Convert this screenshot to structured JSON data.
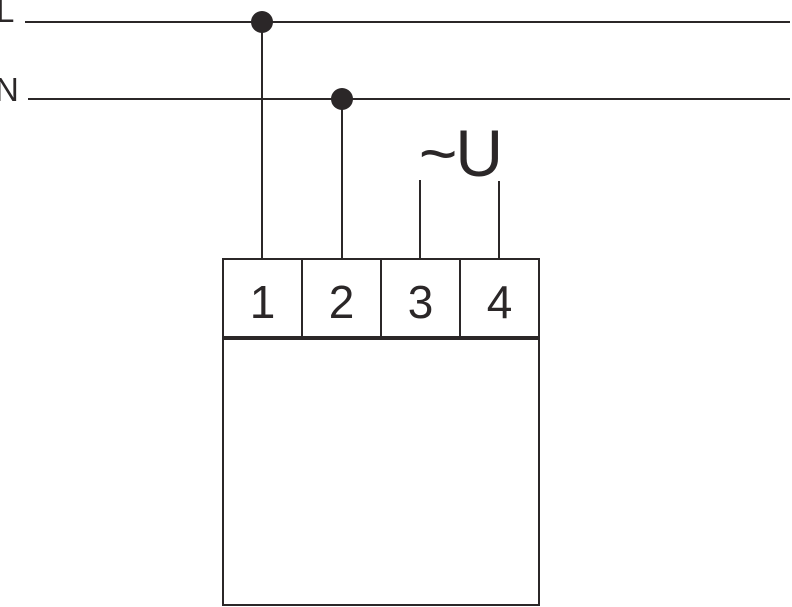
{
  "diagram": {
    "type": "electrical-wiring-connection-diagram",
    "labels": {
      "line": "L",
      "neutral": "N",
      "supply_voltage": "~U"
    },
    "device": {
      "terminals": [
        {
          "number": "1"
        },
        {
          "number": "2"
        },
        {
          "number": "3"
        },
        {
          "number": "4"
        }
      ]
    },
    "connections": [
      {
        "from": "L",
        "to": "terminal 1",
        "via": "junction-dot"
      },
      {
        "from": "N",
        "to": "terminal 2",
        "via": "junction-dot"
      },
      {
        "from": "~U",
        "to": "terminal 3"
      },
      {
        "from": "~U",
        "to": "terminal 4"
      }
    ],
    "colors": {
      "stroke": "#2b2728",
      "background": "#ffffff"
    }
  }
}
